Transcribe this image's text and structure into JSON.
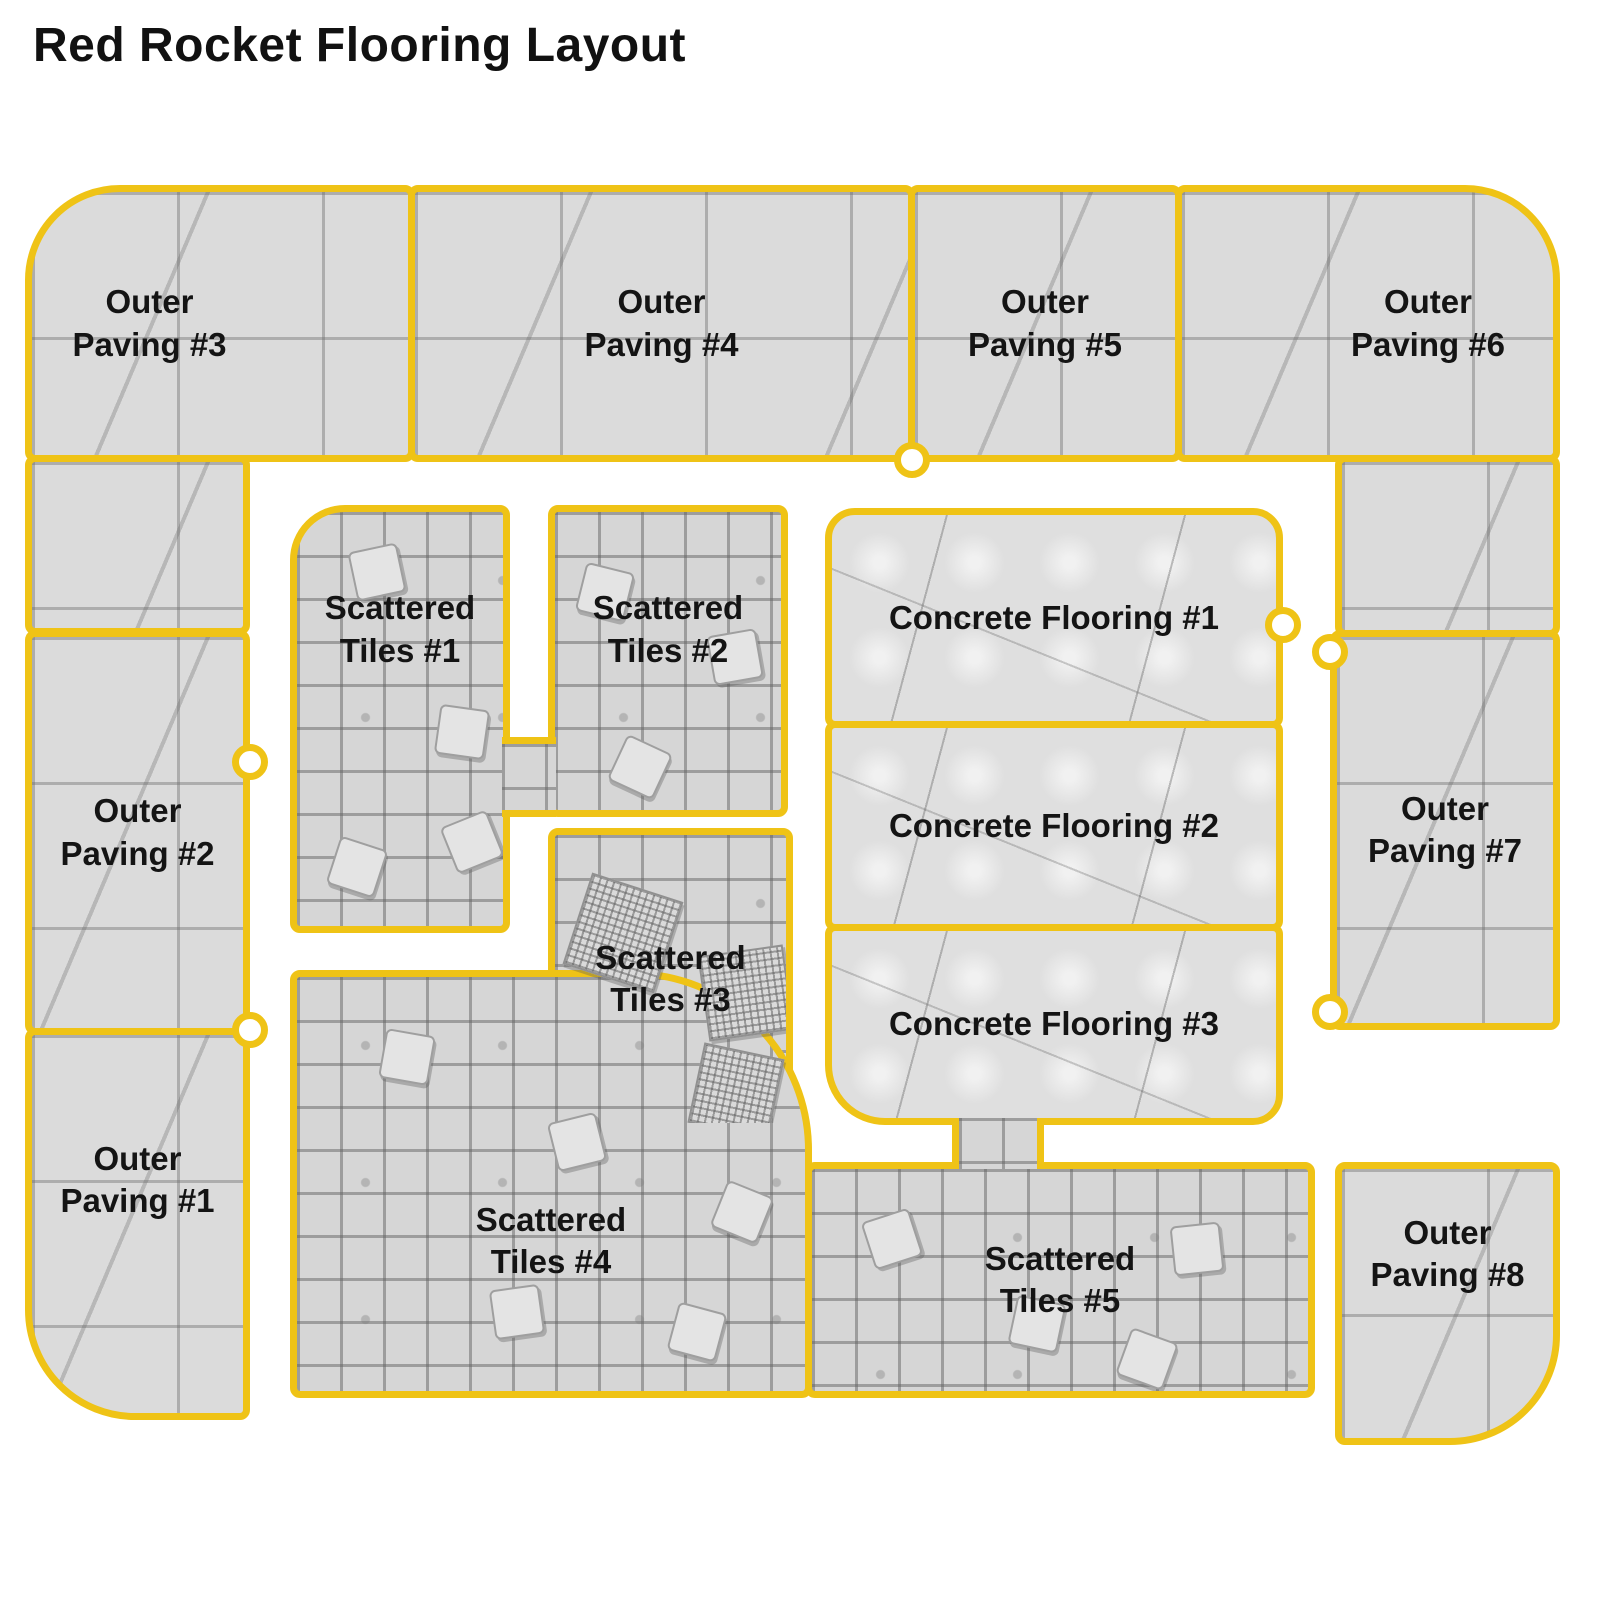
{
  "title": "Red Rocket Flooring Layout",
  "colors": {
    "outline": "#EFC316",
    "floor_gray": "#DBDBDB",
    "label_text": "#141414",
    "background": "#FFFFFF"
  },
  "regions": {
    "op1": {
      "label": "Outer\nPaving #1",
      "type": "outer-paving"
    },
    "op2": {
      "label": "Outer\nPaving #2",
      "type": "outer-paving"
    },
    "op3": {
      "label": "Outer\nPaving #3",
      "type": "outer-paving"
    },
    "op4": {
      "label": "Outer\nPaving #4",
      "type": "outer-paving"
    },
    "op5": {
      "label": "Outer\nPaving #5",
      "type": "outer-paving"
    },
    "op6": {
      "label": "Outer\nPaving #6",
      "type": "outer-paving"
    },
    "op7": {
      "label": "Outer\nPaving #7",
      "type": "outer-paving"
    },
    "op8": {
      "label": "Outer\nPaving #8",
      "type": "outer-paving"
    },
    "st1": {
      "label": "Scattered\nTiles #1",
      "type": "scattered-tiles"
    },
    "st2": {
      "label": "Scattered\nTiles #2",
      "type": "scattered-tiles"
    },
    "st3": {
      "label": "Scattered\nTiles #3",
      "type": "scattered-tiles"
    },
    "st4": {
      "label": "Scattered\nTiles #4",
      "type": "scattered-tiles"
    },
    "st5": {
      "label": "Scattered\nTiles #5",
      "type": "scattered-tiles"
    },
    "cf1": {
      "label": "Concrete Flooring #1",
      "type": "concrete"
    },
    "cf2": {
      "label": "Concrete Flooring #2",
      "type": "concrete"
    },
    "cf3": {
      "label": "Concrete Flooring #3",
      "type": "concrete"
    }
  }
}
